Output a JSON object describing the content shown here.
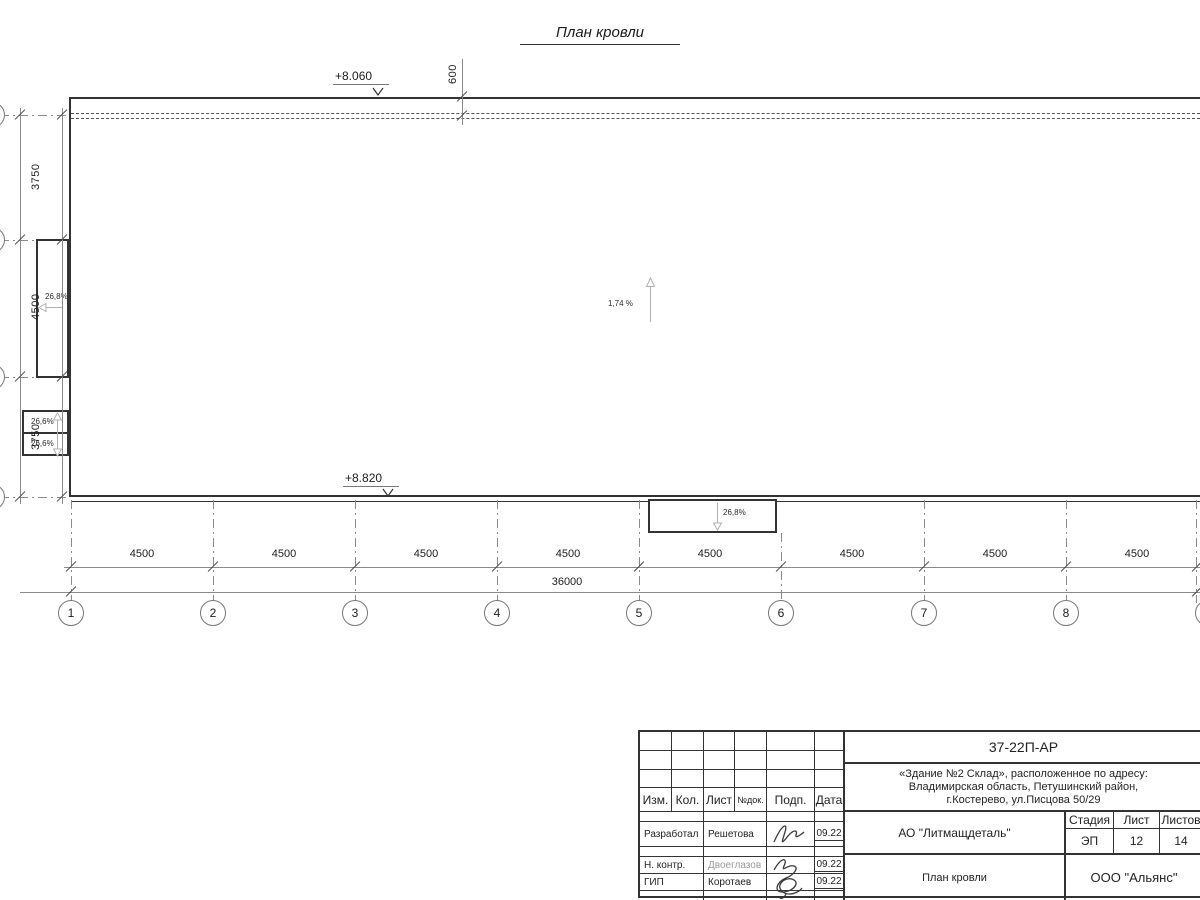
{
  "title": "План кровли",
  "plan": {
    "elevation_top": "+8.060",
    "elevation_bottom": "+8.820",
    "dim_top": "600",
    "slope_center": "1,74 %",
    "slope_left_canopy": "26,8%",
    "slope_small_upper": "26,6%",
    "slope_small_lower": "26,6%",
    "slope_bottom_canopy": "26,8%"
  },
  "dims": {
    "left": [
      "3750",
      "4500",
      "3750"
    ],
    "left_total": "12000",
    "bottom": [
      "4500",
      "4500",
      "4500",
      "4500",
      "4500",
      "4500",
      "4500",
      "4500"
    ],
    "bottom_total": "36000"
  },
  "grid": {
    "bubbles": [
      "1",
      "2",
      "3",
      "4",
      "5",
      "6",
      "7",
      "8",
      "9"
    ]
  },
  "titleblock": {
    "doc_number": "37-22П-АР",
    "address_line1": "«Здание №2 Склад», расположенное по адресу:",
    "address_line2": "Владимирская область, Петушинский район,",
    "address_line3": "г.Костерево, ул.Писцова 50/29",
    "header_cols": {
      "izm": "Изм.",
      "kol": "Кол.",
      "list": "Лист",
      "ndok": "№док.",
      "podp": "Подп.",
      "data": "Дата"
    },
    "staff": [
      {
        "role": "Разработал",
        "name": "Решетова",
        "date": "09.22"
      },
      {
        "role": "Н. контр.",
        "name": "Двоеглазов",
        "date": "09.22"
      },
      {
        "role": "ГИП",
        "name": "Коротаев",
        "date": "09.22"
      }
    ],
    "company": "АО \"Литмащдеталь\"",
    "stage_header": {
      "stage": "Стадия",
      "sheet": "Лист",
      "sheets": "Листов"
    },
    "stage_values": {
      "stage": "ЭП",
      "sheet": "12",
      "sheets": "14"
    },
    "sheet_title": "План кровли",
    "org": "ООО \"Альянс\""
  },
  "colors": {
    "line": "#333333",
    "dim": "#8a8a8a",
    "light_arrow": "#b0b0b0",
    "muted_text": "#999999"
  }
}
